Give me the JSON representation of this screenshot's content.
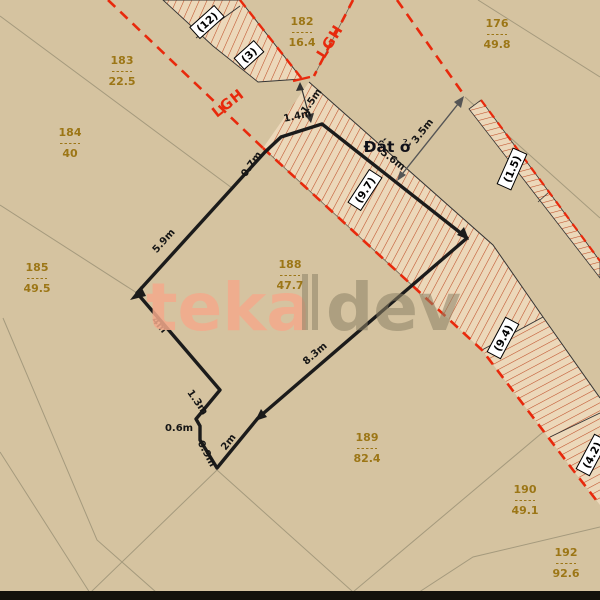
{
  "map": {
    "background": "#d5c3a0",
    "red": "#e8290c",
    "hatch_fill": "#ecd8ba",
    "hatch_line": "#bf4f28",
    "gold": "#9c7616",
    "thin_line": "#a59a7d",
    "boundary_black": "#1b1b1b",
    "bottom_band": "#14120c",
    "land_use_label": {
      "text": "Đất ở",
      "x": 387,
      "y": 152
    },
    "lgh_labels": [
      {
        "text": "LGH",
        "x": 231,
        "y": 107,
        "rot": -38
      },
      {
        "text": "LGH",
        "x": 334,
        "y": 44,
        "rot": -58
      }
    ],
    "parcels": [
      {
        "number": "183",
        "area": "22.5",
        "x": 122,
        "y": 64
      },
      {
        "number": "182",
        "area": "16.4",
        "x": 302,
        "y": 25
      },
      {
        "number": "184",
        "area": "40",
        "x": 70,
        "y": 136
      },
      {
        "number": "176",
        "area": "49.8",
        "x": 497,
        "y": 27
      },
      {
        "number": "185",
        "area": "49.5",
        "x": 37,
        "y": 271
      },
      {
        "number": "188",
        "area": "47.7",
        "x": 290,
        "y": 268
      },
      {
        "number": "189",
        "area": "82.4",
        "x": 367,
        "y": 441
      },
      {
        "number": "190",
        "area": "49.1",
        "x": 525,
        "y": 493
      },
      {
        "number": "192",
        "area": "92.6",
        "x": 566,
        "y": 556
      }
    ],
    "road_labels": [
      {
        "text": "(12)",
        "x": 207,
        "y": 22,
        "rot": -42
      },
      {
        "text": "(3)",
        "x": 249,
        "y": 55,
        "rot": -42
      },
      {
        "text": "(9.7)",
        "x": 365,
        "y": 190,
        "rot": -57
      },
      {
        "text": "(1.5)",
        "x": 512,
        "y": 169,
        "rot": -66
      },
      {
        "text": "(9.4)",
        "x": 503,
        "y": 338,
        "rot": -62
      },
      {
        "text": "(4.2)",
        "x": 592,
        "y": 455,
        "rot": -62
      }
    ],
    "measurements": [
      {
        "text": "5.9m",
        "x": 166,
        "y": 243,
        "rot": -48
      },
      {
        "text": "0.7m",
        "x": 254,
        "y": 166,
        "rot": -55
      },
      {
        "text": "1.4m",
        "x": 298,
        "y": 119,
        "rot": -12
      },
      {
        "text": "1.5m",
        "x": 314,
        "y": 103,
        "rot": -55
      },
      {
        "text": "5.6m",
        "x": 391,
        "y": 162,
        "rot": 38
      },
      {
        "text": "3.5m",
        "x": 425,
        "y": 133,
        "rot": -52
      },
      {
        "text": "4m",
        "x": 157,
        "y": 327,
        "rot": 50
      },
      {
        "text": "1.3m",
        "x": 195,
        "y": 404,
        "rot": 55
      },
      {
        "text": "0.6m",
        "x": 179,
        "y": 431,
        "rot": 0
      },
      {
        "text": "0.9m",
        "x": 204,
        "y": 455,
        "rot": 62
      },
      {
        "text": "2m",
        "x": 231,
        "y": 444,
        "rot": -52
      },
      {
        "text": "8.3m",
        "x": 317,
        "y": 356,
        "rot": -41
      }
    ],
    "watermark": {
      "part1": "teka",
      "part2": "dev",
      "color1": "#f3a98b",
      "color2": "#8d8266"
    }
  }
}
